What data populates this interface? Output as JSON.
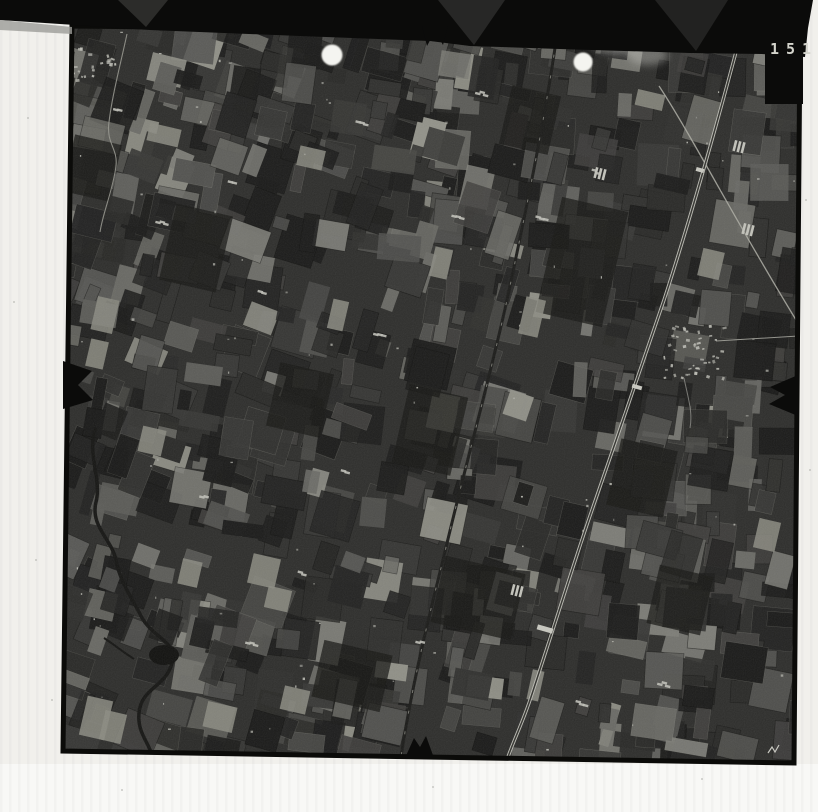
{
  "photo": {
    "frame_number": "151"
  },
  "colors": {
    "paper": "#f1f0ec",
    "paper_bottom": "#f8f8f6",
    "film_band": "#0b0b0a",
    "band_facet": "#3a3a38",
    "photo_base": "#2e2e2c",
    "photo_rim": "#0b0b09",
    "field_palette": [
      "#1b1b1a",
      "#232322",
      "#2a2a28",
      "#31312f",
      "#383836",
      "#403f3d",
      "#484845",
      "#52524f",
      "#5d5d59",
      "#6a6a65",
      "#7d7d77",
      "#929289"
    ],
    "speck": "#b8b8b0",
    "railway": "#bcbcb4",
    "railway_core": "#33332f",
    "road_light": "#a8a8a0",
    "road_dark": "#1c1c1a",
    "river": "#161614",
    "pond": "#121210",
    "white_dot": "#f4f4f0",
    "smoke": "#c9c9c3",
    "digit": "#d4d4cc",
    "dust": "#b5b5b0",
    "shadow_strip": "#9c9c98"
  },
  "scene": {
    "canvas": {
      "w": 818,
      "h": 812
    },
    "photo_polygon": [
      [
        72,
        26
      ],
      [
        800,
        34
      ],
      [
        794,
        763
      ],
      [
        63,
        751
      ]
    ],
    "bottom_white_band": {
      "x": 0,
      "y": 764,
      "w": 818,
      "h": 48
    },
    "film_band": {
      "polygon": [
        [
          0,
          0
        ],
        [
          813,
          0
        ],
        [
          808,
          28
        ],
        [
          805,
          57
        ],
        [
          762,
          54
        ],
        [
          690,
          53
        ],
        [
          560,
          49
        ],
        [
          470,
          46
        ],
        [
          430,
          41
        ],
        [
          300,
          36
        ],
        [
          150,
          30
        ],
        [
          60,
          24
        ],
        [
          0,
          20
        ]
      ],
      "facets": [
        {
          "pts": [
            [
              118,
              0
            ],
            [
              168,
              0
            ],
            [
              146,
              27
            ]
          ],
          "opacity": 0.7
        },
        {
          "pts": [
            [
              438,
              0
            ],
            [
              505,
              0
            ],
            [
              474,
              45
            ]
          ],
          "opacity": 0.6
        },
        {
          "pts": [
            [
              655,
              0
            ],
            [
              728,
              0
            ],
            [
              696,
              51
            ]
          ],
          "opacity": 0.5
        }
      ],
      "shadow_strip": [
        [
          0,
          20
        ],
        [
          72,
          27
        ],
        [
          72,
          34
        ],
        [
          0,
          30
        ]
      ]
    },
    "tab": {
      "x": 765,
      "y": 18,
      "w": 38,
      "h": 86
    },
    "fiducials": {
      "top": "M422,26 L448,26 L443,45 L435,31 L427,46 Z",
      "bottom": "M405,758 L414,738 L420,747 L426,736 L434,758 Z",
      "left": "M63,361 L92,371 L78,385 L93,400 L63,409 Z",
      "right": "M798,375 L770,387 L785,395 L769,404 L798,416 Z"
    },
    "mosaic": {
      "seed": 20,
      "count": 900,
      "x": 58,
      "y": 18,
      "w": 748,
      "h": 750,
      "min_w": 10,
      "max_w": 44,
      "min_h": 12,
      "max_h": 46,
      "angle_left": 17,
      "angle_right": 7,
      "angle_jitter": 16,
      "bias": 1.7,
      "specks": 90
    },
    "dark_blobs": [
      [
        582,
        262,
        68,
        118
      ],
      [
        478,
        598,
        82,
        68
      ],
      [
        352,
        676,
        70,
        58
      ],
      [
        196,
        248,
        58,
        78
      ],
      [
        642,
        478,
        58,
        68
      ],
      [
        92,
        168,
        48,
        58
      ],
      [
        430,
        430,
        60,
        80
      ],
      [
        300,
        400,
        55,
        65
      ],
      [
        530,
        120,
        50,
        60
      ],
      [
        680,
        600,
        55,
        60
      ]
    ],
    "light_fields": [
      [
        83,
        698,
        26,
        40
      ],
      [
        102,
        712,
        22,
        30
      ],
      [
        205,
        704,
        30,
        26
      ],
      [
        282,
        688,
        26,
        24
      ],
      [
        148,
        126,
        32,
        18
      ],
      [
        298,
        148,
        26,
        20
      ],
      [
        94,
        298,
        22,
        34
      ],
      [
        140,
        428,
        24,
        26
      ],
      [
        250,
        556,
        28,
        30
      ],
      [
        266,
        588,
        24,
        22
      ],
      [
        522,
        298,
        20,
        38
      ],
      [
        432,
        248,
        18,
        30
      ],
      [
        636,
        92,
        28,
        16
      ],
      [
        700,
        250,
        22,
        28
      ],
      [
        756,
        520,
        22,
        30
      ],
      [
        180,
        560,
        20,
        26
      ],
      [
        88,
        340,
        18,
        28
      ],
      [
        330,
        300,
        16,
        30
      ]
    ],
    "railway": {
      "path": "M741,33 C716,128 690,220 664,300 C640,372 616,440 592,510 C574,562 550,640 530,700 C522,724 513,742 508,757",
      "station_bars": [
        [
          545,
          629,
          16,
          5
        ],
        [
          637,
          387,
          10,
          4
        ],
        [
          700,
          170,
          8,
          4
        ]
      ]
    },
    "west_road": {
      "path": "M557,34 C545,120 524,220 507,300 C489,382 464,470 443,560 C428,620 411,690 401,757"
    },
    "crossing_road": {
      "path": "M659,86 C692,136 738,226 801,328"
    },
    "east_road": {
      "path": "M716,341 L799,336"
    },
    "south_road": {
      "path": "M684,378 C688,398 693,412 690,428"
    },
    "north_road": {
      "path": "M127,34 C121,62 112,96 109,122 C106,144 118,148 116,166 C113,190 103,212 100,232"
    },
    "river": {
      "path": "M96,428 C86,452 102,478 96,502 C90,526 112,540 116,560 C120,582 132,598 141,616 C152,638 178,641 172,663 C166,687 141,688 139,713 C137,735 151,743 153,761",
      "branch": "M104,638 C116,646 126,654 134,659",
      "pond": [
        164,
        655,
        15,
        10
      ]
    },
    "villages": [
      {
        "cx": 90,
        "cy": 60,
        "rx": 26,
        "ry": 21,
        "n": 26
      },
      {
        "cx": 692,
        "cy": 352,
        "rx": 31,
        "ry": 27,
        "n": 44
      }
    ],
    "farmsteads": [
      [
        378,
        331
      ],
      [
        596,
        169
      ],
      [
        456,
        214
      ],
      [
        232,
        181
      ],
      [
        118,
        106
      ],
      [
        302,
        571
      ],
      [
        662,
        681
      ],
      [
        204,
        494
      ],
      [
        345,
        470
      ],
      [
        262,
        290
      ],
      [
        540,
        215
      ],
      [
        420,
        640
      ],
      [
        580,
        700
      ],
      [
        160,
        220
      ],
      [
        250,
        640
      ],
      [
        480,
        90
      ],
      [
        360,
        120
      ]
    ],
    "greenhouses": [
      [
        735,
        140
      ],
      [
        744,
        223
      ],
      [
        513,
        584
      ],
      [
        596,
        167
      ]
    ],
    "white_dots": [
      [
        332,
        55,
        10.5
      ],
      [
        583,
        62,
        9.5
      ]
    ],
    "smoke": [
      [
        617,
        42,
        26,
        12
      ],
      [
        648,
        55,
        20,
        10
      ],
      [
        598,
        33,
        14,
        8
      ]
    ],
    "handwritten_mark": "M768,753 l4,-6 l3,5 l4,-7",
    "dust": [
      [
        28,
        118
      ],
      [
        14,
        302
      ],
      [
        151,
        466
      ],
      [
        36,
        560
      ],
      [
        122,
        790
      ],
      [
        433,
        787
      ],
      [
        702,
        779
      ],
      [
        52,
        700
      ],
      [
        806,
        200
      ],
      [
        810,
        470
      ]
    ]
  }
}
